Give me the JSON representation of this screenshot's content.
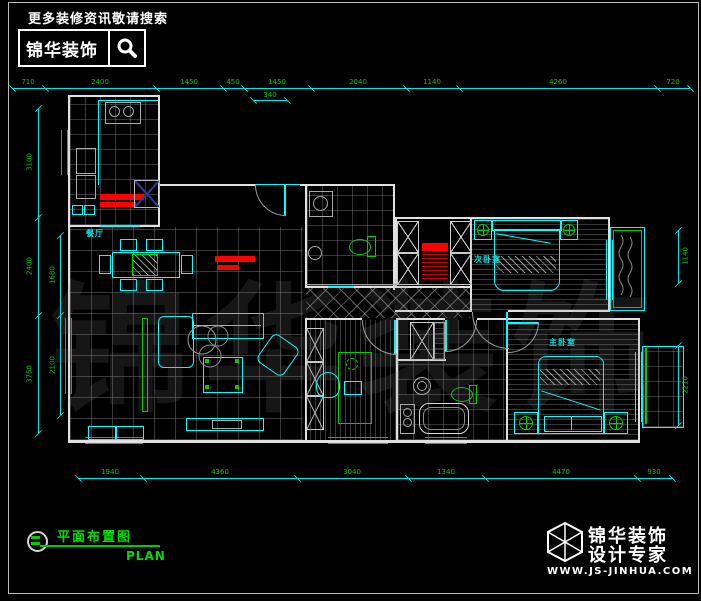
{
  "header": {
    "search_hint": "更多装修资讯敬请搜索",
    "brand": "锦华装饰"
  },
  "title_block": {
    "title": "平面布置图",
    "subtitle": "PLAN"
  },
  "footer_logo": {
    "line1": "锦华装饰",
    "line2": "设计专家",
    "website": "WWW.JS-JINHUA.COM"
  },
  "watermark": "锦华装饰",
  "rooms": {
    "dining": "餐厅",
    "second_bedroom": "次卧室",
    "master_bedroom": "主卧室"
  },
  "dims": {
    "top": [
      "710",
      "2400",
      "1450",
      "450",
      "1450",
      "2040",
      "1140",
      "4260",
      "720"
    ],
    "top_sub": "340",
    "bottom": [
      "1940",
      "4360",
      "3040",
      "1340",
      "4470",
      "930"
    ],
    "left_outer": [
      "3100",
      "2400",
      "3750"
    ],
    "left_inner": [
      "1680",
      "2100"
    ],
    "right": [
      "1140",
      "2210"
    ]
  },
  "colors": {
    "cad_line": "#00ffff",
    "dim_text": "#00cc00",
    "annotation_green": "#00dd00",
    "accent_red": "#ff0000",
    "wall": "#e0e0e0"
  }
}
